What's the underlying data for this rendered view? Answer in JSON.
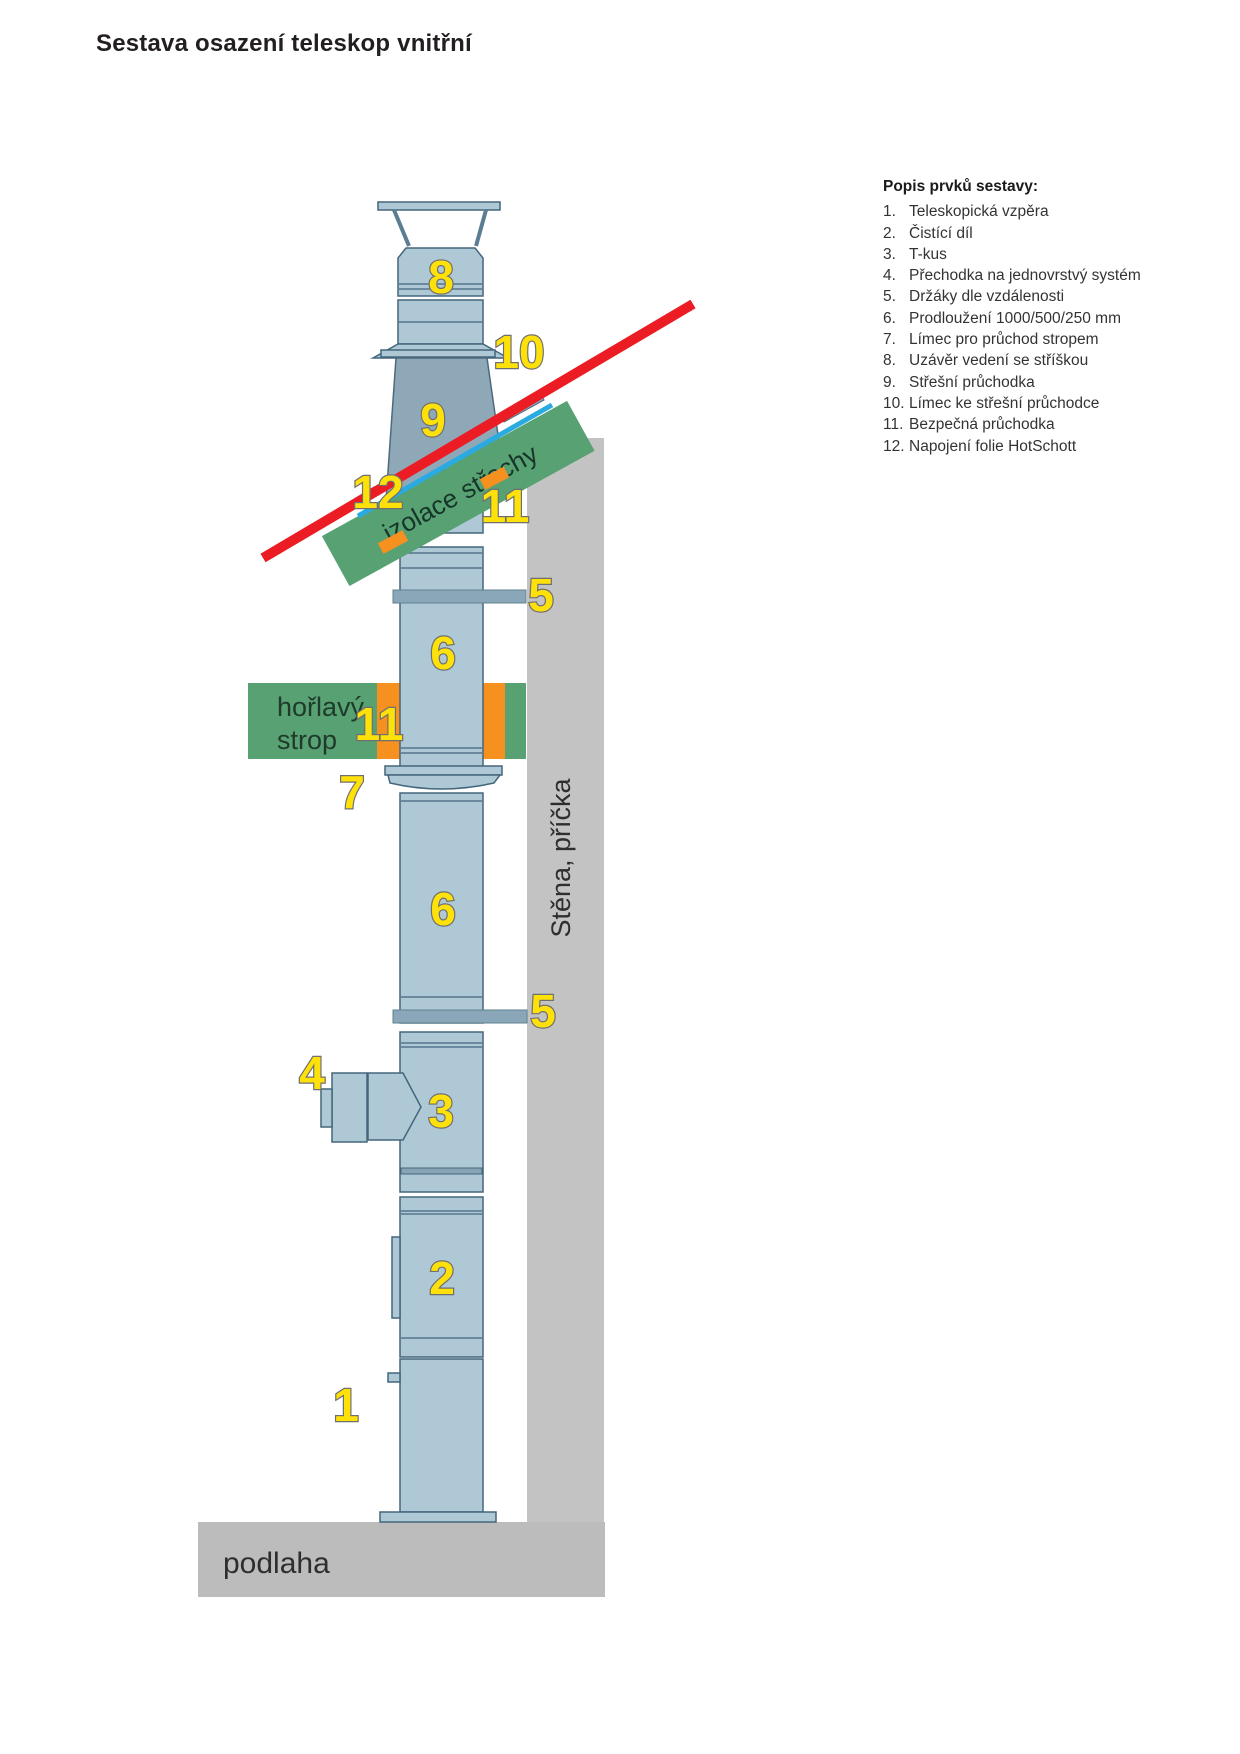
{
  "title": "Sestava osazení teleskop vnitřní",
  "legend": {
    "title": "Popis prvků sestavy:",
    "items": [
      {
        "num": "1.",
        "text": "Teleskopická vzpěra"
      },
      {
        "num": "2.",
        "text": "Čistící díl"
      },
      {
        "num": "3.",
        "text": "T-kus"
      },
      {
        "num": "4.",
        "text": "Přechodka na jednovrstvý systém"
      },
      {
        "num": "5.",
        "text": "Držáky dle  vzdálenosti"
      },
      {
        "num": "6.",
        "text": "Prodloužení 1000/500/250 mm"
      },
      {
        "num": "7.",
        "text": "Límec pro průchod stropem"
      },
      {
        "num": "8.",
        "text": "Uzávěr vedení se stříškou"
      },
      {
        "num": "9.",
        "text": "Střešní průchodka"
      },
      {
        "num": "10.",
        "text": "Límec ke střešní průchodce"
      },
      {
        "num": "11.",
        "text": "Bezpečná průchodka"
      },
      {
        "num": "12.",
        "text": "Napojení folie HotSchott"
      }
    ]
  },
  "diagram": {
    "callouts": [
      {
        "part": "cap",
        "text": "8"
      },
      {
        "part": "roof-collar",
        "text": "10"
      },
      {
        "part": "roof-penetration",
        "text": "9"
      },
      {
        "part": "foil-connection",
        "text": "12"
      },
      {
        "part": "safe-penetration-roof",
        "text": "11"
      },
      {
        "part": "bracket-upper",
        "text": "5"
      },
      {
        "part": "extension-upper",
        "text": "6"
      },
      {
        "part": "safe-penetration-ceiling",
        "text": "11"
      },
      {
        "part": "ceiling-collar",
        "text": "7"
      },
      {
        "part": "extension-lower",
        "text": "6"
      },
      {
        "part": "bracket-lower",
        "text": "5"
      },
      {
        "part": "adapter",
        "text": "4"
      },
      {
        "part": "tee",
        "text": "3"
      },
      {
        "part": "cleaning-section",
        "text": "2"
      },
      {
        "part": "telescopic-strut",
        "text": "1"
      }
    ],
    "annotations": {
      "roof_insulation": "izolace střechy",
      "flammable_ceiling_line1": "hořlavý",
      "flammable_ceiling_line2": "strop",
      "wall": "Stěna, příčka",
      "floor": "podlaha"
    },
    "colors": {
      "pipe": "#aec8d6",
      "cone": "#8ea8b8",
      "insulation_green": "#57a172",
      "seal_orange": "#f69120",
      "roof_line_red": "#ec1c24",
      "membrane_blue": "#29abe2",
      "callout_yellow": "#ffe10a",
      "wall_gray": "#c3c3c3",
      "floor_gray": "#bcbcbc"
    }
  }
}
